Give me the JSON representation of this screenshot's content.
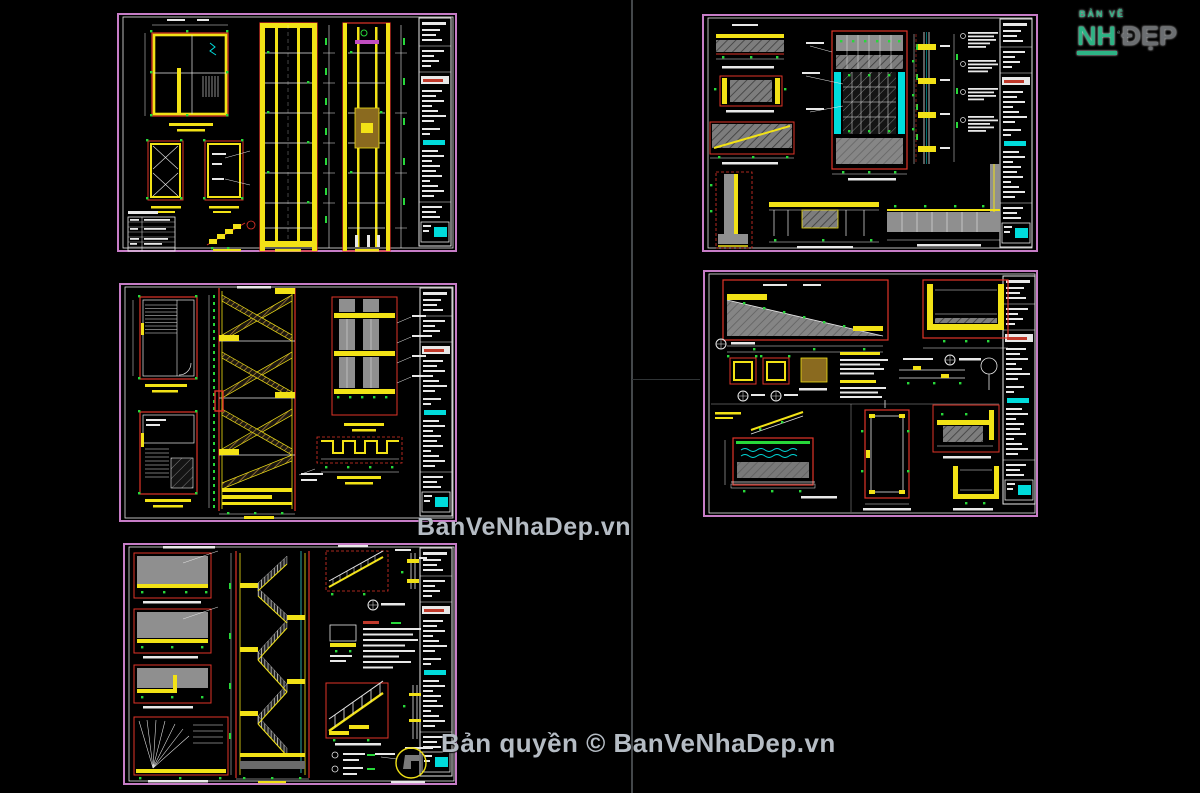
{
  "watermarks": {
    "center_text": "BanVeNhaDep.vn",
    "bottom_text": "Bản quyền © BanVeNhaDep.vn"
  },
  "logo": {
    "top_text": "BẢN VẼ",
    "left_text": "NH",
    "right_text": "ĐẸP"
  },
  "colors": {
    "background": "#000000",
    "divider": "#43474a",
    "sheet_border": "#c77dc7",
    "cad_yellow": "#f2e216",
    "cad_red": "#e03428",
    "cad_green": "#27d83a",
    "cad_cyan": "#00dcdc",
    "cad_white": "#e8e8e8",
    "cad_gray": "#8f8f8f",
    "watermark_color": "#b5bcc4",
    "logo_teal": "#2db385",
    "logo_gray": "#6b6e71"
  }
}
